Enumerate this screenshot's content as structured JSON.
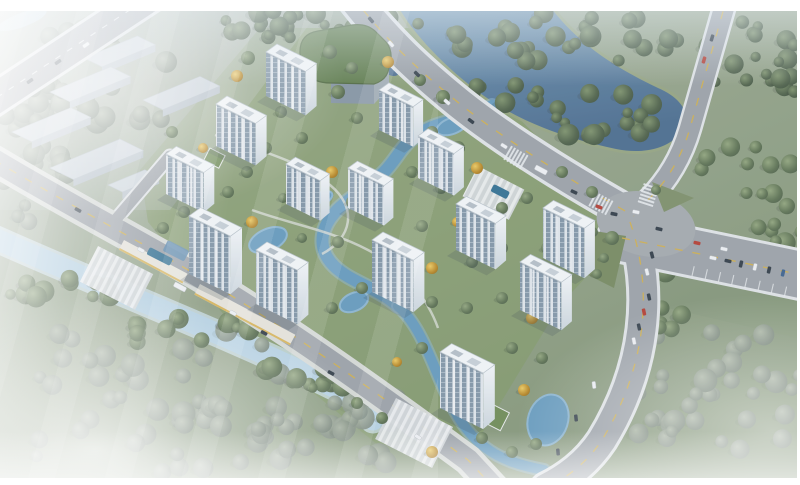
{
  "palette": {
    "frame_white": "#ffffff",
    "grass_light": "#adb7ae",
    "grass_mid": "#93a287",
    "grass_deep": "#7e9170",
    "lawn": "#7d985c",
    "asphalt": "#9aa0a5",
    "asphalt_light": "#a2a7ab",
    "casing": "#dfe3e5",
    "sidewalk": "#d5d8d4",
    "line_yellow": "#d2ae44",
    "line_white": "#e9ecee",
    "river_deep": "#47698b",
    "river_light": "#6f95b0",
    "canal": "#b5d1e1",
    "canal_casing": "#cfe2ee",
    "stream": "#6298ba",
    "pool": "#2f6e8f",
    "tower_roof": "#f2f5f6",
    "tower_end": "#eef2f4",
    "tower_window": "#7f93a4",
    "warehouse_roof": "#c9d2d9",
    "warehouse_face": "#b0bbc4",
    "green_roof": "#5e7b4a",
    "plaza": "#d3d7d9",
    "podium": "#e7e4da",
    "podium_trim": "#d9b55a",
    "canopy_blue": "#5d89ad",
    "car_dark": "#2e3943",
    "car_white": "#eef0f2",
    "car_red": "#b33a2e",
    "car_blue": "#3a5f8a",
    "shadow": "#3c4750"
  },
  "frame": {
    "top": 11,
    "right": 3,
    "bottom": 7,
    "left": 0
  },
  "ground": {
    "tints": [
      {
        "d": "M 140,170 L 260,28 L 430,28 L 570,170 L 628,232 L 560,305 L 475,445 L 378,445 L 238,332 L 148,222 Z",
        "fill": "lawn",
        "op": 0.55
      },
      {
        "d": "M 640,225 L 806,268 L 806,340 L 655,305 Z",
        "fill": "grass_deep",
        "op": 0.4
      },
      {
        "d": "M 0,110 L 160,10 L 320,10 L 170,210 L 0,210 Z",
        "fill": "grass_light",
        "op": 0.45
      }
    ],
    "corner_water": {
      "cx": 22,
      "cy": 20,
      "rx": 26,
      "ry": 7,
      "rot": -20
    }
  },
  "water": {
    "river_d": "M 396,4 L 548,4 C 576,42 612,66 658,88 C 686,100 694,120 678,136 C 664,150 640,154 616,149 C 574,140 538,128 506,110 C 466,87 428,50 408,22 Z",
    "river_sw": {
      "cx": 386,
      "cy": 54,
      "rx": 13,
      "ry": 24,
      "rot": -28
    },
    "canal_d": "M -6,238 C 70,272 150,304 232,340 C 292,366 330,385 356,398 C 368,404 372,410 373,420",
    "streams": [
      {
        "d": "M 492,106 C 466,120 448,120 430,128 C 402,140 400,156 384,172 C 364,192 344,200 332,216 C 318,234 320,252 334,266 C 350,282 378,288 398,306",
        "w": 12
      },
      {
        "d": "M 398,306 C 418,324 428,352 440,380 C 452,408 464,432 486,448 C 502,460 522,466 544,470",
        "w": 10
      }
    ],
    "ponds": [
      [
        268,
        240,
        20,
        11,
        -24
      ],
      [
        354,
        302,
        15,
        9,
        -24
      ],
      [
        452,
        126,
        16,
        8,
        -20
      ],
      [
        322,
        198,
        11,
        6,
        -24
      ],
      [
        548,
        420,
        20,
        26,
        18
      ]
    ]
  },
  "forest_clusters": [
    [
      300,
      24,
      135,
      14,
      26,
      "d"
    ],
    [
      560,
      38,
      120,
      26,
      30,
      "d"
    ],
    [
      600,
      118,
      62,
      26,
      16,
      "d"
    ],
    [
      755,
      62,
      52,
      48,
      22,
      "d"
    ],
    [
      745,
      168,
      58,
      40,
      10,
      "g"
    ],
    [
      712,
      392,
      92,
      74,
      34,
      "h"
    ],
    [
      160,
      398,
      205,
      78,
      55,
      "h"
    ],
    [
      345,
      432,
      90,
      42,
      22,
      "h"
    ],
    [
      38,
      182,
      38,
      55,
      13,
      "h"
    ],
    [
      62,
      287,
      58,
      17,
      12,
      "g"
    ],
    [
      182,
      330,
      68,
      19,
      14,
      "g"
    ],
    [
      298,
      376,
      58,
      17,
      12,
      "g"
    ],
    [
      72,
      40,
      48,
      15,
      10,
      "h"
    ],
    [
      30,
      122,
      33,
      13,
      8,
      "h"
    ],
    [
      508,
      96,
      48,
      13,
      8,
      "d"
    ],
    [
      100,
      92,
      85,
      55,
      18,
      "h"
    ],
    [
      660,
      300,
      26,
      36,
      10,
      "g"
    ],
    [
      775,
      225,
      30,
      28,
      8,
      "g"
    ]
  ],
  "trees": [
    [
      248,
      58,
      7,
      "g"
    ],
    [
      237,
      76,
      6,
      "y"
    ],
    [
      330,
      52,
      7,
      "g"
    ],
    [
      352,
      68,
      6,
      "g"
    ],
    [
      388,
      62,
      6,
      "y"
    ],
    [
      420,
      80,
      6,
      "g"
    ],
    [
      443,
      97,
      7,
      "g"
    ],
    [
      338,
      92,
      7,
      "g"
    ],
    [
      311,
      99,
      5,
      "y"
    ],
    [
      281,
      112,
      6,
      "g"
    ],
    [
      227,
      118,
      6,
      "g"
    ],
    [
      357,
      118,
      6,
      "g"
    ],
    [
      396,
      118,
      5,
      "y"
    ],
    [
      432,
      132,
      6,
      "g"
    ],
    [
      458,
      148,
      7,
      "g"
    ],
    [
      477,
      168,
      6,
      "y"
    ],
    [
      302,
      138,
      6,
      "g"
    ],
    [
      266,
      148,
      6,
      "g"
    ],
    [
      203,
      148,
      5,
      "y"
    ],
    [
      172,
      132,
      6,
      "g"
    ],
    [
      247,
      172,
      6,
      "g"
    ],
    [
      332,
      172,
      6,
      "y"
    ],
    [
      412,
      172,
      6,
      "g"
    ],
    [
      441,
      188,
      6,
      "g"
    ],
    [
      352,
      202,
      6,
      "g"
    ],
    [
      382,
      212,
      5,
      "y"
    ],
    [
      318,
      208,
      5,
      "g"
    ],
    [
      283,
      198,
      5,
      "g"
    ],
    [
      228,
      192,
      6,
      "g"
    ],
    [
      184,
      212,
      6,
      "g"
    ],
    [
      163,
      228,
      6,
      "g"
    ],
    [
      252,
      222,
      6,
      "y"
    ],
    [
      302,
      238,
      5,
      "g"
    ],
    [
      338,
      242,
      6,
      "g"
    ],
    [
      422,
      226,
      6,
      "g"
    ],
    [
      457,
      222,
      5,
      "y"
    ],
    [
      502,
      208,
      6,
      "g"
    ],
    [
      527,
      198,
      6,
      "g"
    ],
    [
      562,
      172,
      6,
      "g"
    ],
    [
      592,
      192,
      6,
      "g"
    ],
    [
      612,
      238,
      7,
      "g"
    ],
    [
      582,
      252,
      5,
      "y"
    ],
    [
      547,
      248,
      6,
      "g"
    ],
    [
      502,
      248,
      6,
      "g"
    ],
    [
      472,
      262,
      6,
      "g"
    ],
    [
      432,
      268,
      6,
      "y"
    ],
    [
      397,
      278,
      6,
      "g"
    ],
    [
      362,
      288,
      6,
      "g"
    ],
    [
      332,
      308,
      6,
      "g"
    ],
    [
      302,
      298,
      5,
      "y"
    ],
    [
      432,
      302,
      6,
      "g"
    ],
    [
      467,
      308,
      6,
      "g"
    ],
    [
      502,
      298,
      6,
      "g"
    ],
    [
      532,
      318,
      6,
      "y"
    ],
    [
      562,
      308,
      6,
      "g"
    ],
    [
      422,
      348,
      6,
      "g"
    ],
    [
      397,
      362,
      5,
      "y"
    ],
    [
      512,
      348,
      6,
      "g"
    ],
    [
      542,
      358,
      6,
      "g"
    ],
    [
      482,
      438,
      6,
      "g"
    ],
    [
      512,
      452,
      6,
      "g"
    ],
    [
      432,
      452,
      6,
      "y"
    ],
    [
      382,
      418,
      6,
      "g"
    ],
    [
      357,
      403,
      6,
      "g"
    ],
    [
      593,
      232,
      5,
      "g"
    ],
    [
      604,
      258,
      5,
      "g"
    ],
    [
      597,
      274,
      5,
      "g"
    ],
    [
      656,
      190,
      5,
      "g"
    ],
    [
      524,
      390,
      6,
      "y"
    ],
    [
      536,
      444,
      6,
      "g"
    ]
  ],
  "warehouses": [
    [
      84,
      58,
      58,
      20
    ],
    [
      50,
      92,
      66,
      22
    ],
    [
      143,
      100,
      62,
      22
    ],
    [
      12,
      132,
      64,
      22
    ],
    [
      50,
      168,
      76,
      26
    ],
    [
      108,
      185,
      40,
      16
    ]
  ],
  "roads": {
    "list": [
      {
        "id": "road-top-left",
        "d": "M 154,-6 L -10,102",
        "w": 30,
        "cw": 36,
        "line": "white"
      },
      {
        "id": "road-branch-warehouse",
        "d": "M 112,224 L 170,156",
        "w": 11,
        "cw": 15,
        "line": "none"
      },
      {
        "id": "road-southwest",
        "d": "M -6,160 C 80,212 178,260 260,314 C 330,359 400,410 468,460 L 494,488",
        "w": 22,
        "cw": 31,
        "line": "yellow"
      },
      {
        "id": "road-main-arterial",
        "d": "M 352,-4 C 386,40 418,70 460,104 C 508,142 570,180 634,216",
        "w": 30,
        "cw": 37,
        "line": "yellow"
      },
      {
        "id": "road-east-branch",
        "d": "M 622,238 C 680,250 740,262 806,276",
        "w": 46,
        "cw": 52,
        "line": "yellow"
      },
      {
        "id": "road-south-branch",
        "d": "M 630,222 C 654,290 646,368 602,440 C 586,464 566,478 546,488",
        "w": 28,
        "cw": 34,
        "line": "yellow"
      },
      {
        "id": "road-north-vertical",
        "d": "M 728,-6 L 690,128 C 682,156 668,180 648,200",
        "w": 20,
        "cw": 25,
        "line": "yellow"
      }
    ],
    "intersection": {
      "cx": 646,
      "cy": 224,
      "rx": 50,
      "ry": 32,
      "rot": 12
    },
    "island_d": "M 652,182 L 694,198 L 664,212 Z",
    "patch_d": "M 588,230 L 626,236 L 614,288 L 586,274 Z",
    "parking": {
      "x0": 692,
      "y0": 276,
      "dx": 13.2,
      "dy": 2.9,
      "n": 8,
      "px": 2.2,
      "py": -9.7
    },
    "zebras": [
      [
        600,
        203,
        28
      ],
      [
        648,
        196,
        -72
      ],
      [
        515,
        157,
        30
      ]
    ]
  },
  "site": {
    "plazas": [
      [
        98,
        246,
        62,
        40
      ],
      [
        478,
        166,
        52,
        34
      ],
      [
        396,
        398,
        64,
        46
      ]
    ],
    "pools": [
      [
        150,
        247,
        26,
        8
      ],
      [
        494,
        184,
        18,
        8
      ]
    ],
    "podiums": [
      [
        124,
        240,
        72,
        11
      ],
      [
        200,
        284,
        108,
        12
      ]
    ],
    "canopies": [
      [
        168,
        240,
        24,
        12
      ]
    ],
    "paths": [
      "M 215,135 C 258,150 298,160 330,185 C 358,208 352,238 322,254",
      "M 252,210 C 290,224 330,230 368,250 C 406,270 428,300 438,328"
    ],
    "pavilions": [
      [
        488,
        402,
        24,
        20
      ],
      [
        210,
        148,
        17,
        14
      ]
    ],
    "green_building": {
      "roof_d": "M 300,54 Q 299,34 318,31 L 352,25 Q 366,23 375,31 L 386,42 Q 392,49 391,60 L 389,68 Q 387,80 374,84 L 331,83 Q 312,83 304,71 Z",
      "right_d": "M 389,68 L 374,84 L 374,104 L 389,88 Z",
      "front_d": "M 374,84 L 331,83 L 331,103 L 374,104 Z"
    }
  },
  "towers": [
    [
      266,
      52,
      44,
      20,
      44
    ],
    [
      216,
      104,
      44,
      20,
      42
    ],
    [
      166,
      154,
      42,
      19,
      40
    ],
    [
      189,
      216,
      46,
      21,
      58
    ],
    [
      379,
      90,
      38,
      18,
      40
    ],
    [
      418,
      136,
      40,
      18,
      42
    ],
    [
      286,
      164,
      38,
      17,
      40
    ],
    [
      348,
      168,
      40,
      17,
      40
    ],
    [
      256,
      250,
      46,
      20,
      54
    ],
    [
      372,
      240,
      46,
      20,
      52
    ],
    [
      456,
      204,
      44,
      19,
      46
    ],
    [
      543,
      208,
      46,
      19,
      50
    ],
    [
      520,
      262,
      46,
      19,
      48
    ],
    [
      440,
      352,
      48,
      21,
      56
    ]
  ],
  "cars": [
    [
      58,
      62,
      -34,
      "k"
    ],
    [
      86,
      45,
      -34,
      "w"
    ],
    [
      30,
      81,
      -34,
      "k"
    ],
    [
      78,
      210,
      29,
      "k"
    ],
    [
      141,
      250,
      29,
      "w"
    ],
    [
      180,
      287,
      28,
      "t"
    ],
    [
      233,
      313,
      28,
      "w"
    ],
    [
      264,
      333,
      28,
      "k"
    ],
    [
      331,
      373,
      27,
      "k"
    ],
    [
      418,
      437,
      33,
      "w"
    ],
    [
      371,
      20,
      50,
      "k"
    ],
    [
      391,
      44,
      49,
      "w"
    ],
    [
      417,
      74,
      45,
      "k"
    ],
    [
      447,
      102,
      40,
      "w"
    ],
    [
      471,
      121,
      37,
      "k"
    ],
    [
      504,
      146,
      32,
      "w"
    ],
    [
      541,
      170,
      28,
      "t"
    ],
    [
      574,
      192,
      25,
      "k"
    ],
    [
      599,
      207,
      22,
      "r"
    ],
    [
      614,
      214,
      12,
      "k"
    ],
    [
      636,
      212,
      12,
      "w"
    ],
    [
      659,
      229,
      14,
      "k"
    ],
    [
      697,
      243,
      13,
      "r"
    ],
    [
      724,
      249,
      13,
      "w"
    ],
    [
      649,
      297,
      78,
      "k"
    ],
    [
      644,
      312,
      78,
      "r"
    ],
    [
      639,
      327,
      78,
      "k"
    ],
    [
      634,
      341,
      79,
      "w"
    ],
    [
      652,
      255,
      75,
      "k"
    ],
    [
      647,
      272,
      76,
      "w"
    ],
    [
      594,
      385,
      83,
      "w"
    ],
    [
      576,
      418,
      84,
      "k"
    ],
    [
      558,
      452,
      85,
      "k"
    ],
    [
      741,
      264,
      -77,
      "k"
    ],
    [
      755,
      267,
      -77,
      "w"
    ],
    [
      769,
      270,
      -77,
      "k"
    ],
    [
      783,
      273,
      -77,
      "b"
    ],
    [
      713,
      258,
      13,
      "w"
    ],
    [
      728,
      261,
      13,
      "k"
    ],
    [
      704,
      60,
      -74,
      "r"
    ],
    [
      712,
      38,
      -74,
      "k"
    ]
  ]
}
